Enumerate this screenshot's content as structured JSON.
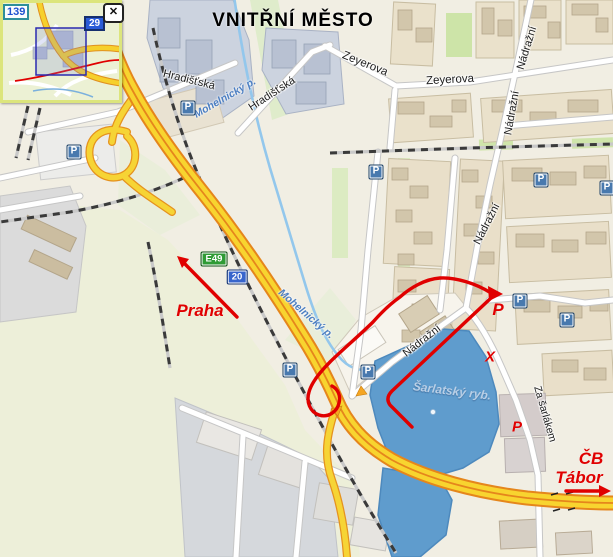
{
  "title": "VNITŘNÍ MĚSTO",
  "minimap": {
    "badge_139": "139",
    "badge_29": "29",
    "close": "✕"
  },
  "road_shields": [
    {
      "name": "shield-e49",
      "text": "E49",
      "x": 214,
      "y": 259,
      "type": "green"
    },
    {
      "name": "shield-20",
      "text": "20",
      "x": 237,
      "y": 277,
      "type": "blue"
    }
  ],
  "street_labels": [
    {
      "text": "Hradišťská",
      "x": 189,
      "y": 80,
      "rot": 14,
      "size": 11
    },
    {
      "text": "Hradišťská",
      "x": 272,
      "y": 94,
      "rot": -33,
      "size": 11
    },
    {
      "text": "Zeyerova",
      "x": 365,
      "y": 64,
      "rot": 22,
      "size": 11.5
    },
    {
      "text": "Zeyerova",
      "x": 450,
      "y": 80,
      "rot": -3,
      "size": 11.5
    },
    {
      "text": "Nádražní",
      "x": 527,
      "y": 48,
      "rot": -73,
      "size": 11
    },
    {
      "text": "Nádražní",
      "x": 512,
      "y": 113,
      "rot": -80,
      "size": 11
    },
    {
      "text": "Nádražní",
      "x": 487,
      "y": 224,
      "rot": -63,
      "size": 11
    },
    {
      "text": "Nádražní",
      "x": 422,
      "y": 341,
      "rot": -38,
      "size": 11
    },
    {
      "text": "Za šarlákem",
      "x": 545,
      "y": 414,
      "rot": 74,
      "size": 10.5
    }
  ],
  "water_labels": [
    {
      "text": "Mohelnický p.",
      "x": 225,
      "y": 98,
      "rot": -30,
      "size": 10.5,
      "kind": "stream"
    },
    {
      "text": "Mohelnický p.",
      "x": 306,
      "y": 314,
      "rot": 41,
      "size": 10.5,
      "kind": "stream"
    },
    {
      "text": "Šarlatský ryb.",
      "x": 452,
      "y": 391,
      "rot": 7,
      "size": 12,
      "kind": "pond"
    }
  ],
  "route_labels": [
    {
      "name": "praha-label",
      "text": "Praha",
      "x": 200,
      "y": 311,
      "size": 17
    },
    {
      "name": "parking-mark-1",
      "text": "P",
      "x": 498,
      "y": 310,
      "size": 17
    },
    {
      "name": "x-mark",
      "text": "X",
      "x": 490,
      "y": 357,
      "size": 15
    },
    {
      "name": "parking-mark-2",
      "text": "P",
      "x": 517,
      "y": 427,
      "size": 15
    },
    {
      "name": "cb-label",
      "text": "ČB",
      "x": 591,
      "y": 459,
      "size": 17
    },
    {
      "name": "tabor-label",
      "text": "Tábor",
      "x": 579,
      "y": 478,
      "size": 17
    }
  ],
  "parking": {
    "letter": "P",
    "positions": [
      {
        "x": 188,
        "y": 108
      },
      {
        "x": 74,
        "y": 152
      },
      {
        "x": 376,
        "y": 172
      },
      {
        "x": 541,
        "y": 180
      },
      {
        "x": 607,
        "y": 188
      },
      {
        "x": 520,
        "y": 301
      },
      {
        "x": 567,
        "y": 320
      },
      {
        "x": 290,
        "y": 370
      },
      {
        "x": 368,
        "y": 372
      }
    ]
  },
  "colors": {
    "route_red": "#e00000",
    "highway_yellow": "#f8d42f",
    "highway_casing": "#e5861c",
    "water_blue": "#5f9ccd",
    "rail_dark": "#3a3a3a"
  }
}
